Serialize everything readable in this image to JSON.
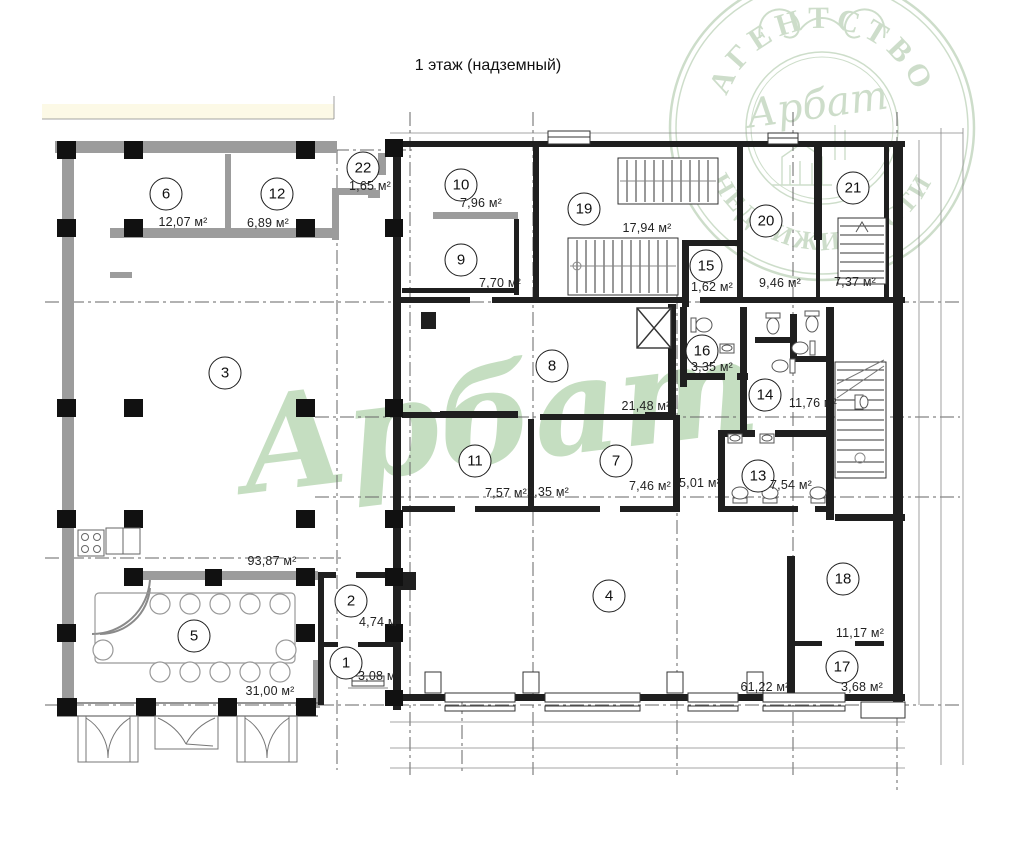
{
  "title": "1 этаж (надземный)",
  "units_suffix": "м²",
  "watermark": {
    "stamp_top_text": "АГЕНТСТВО",
    "stamp_bottom_text": "НЕДВИЖИМОСТИ",
    "stamp_script": "Арбат",
    "center_script": "Арбат",
    "color": "#97c48f"
  },
  "rooms": [
    {
      "number": "1",
      "area": "3,08 м²"
    },
    {
      "number": "2",
      "area": "4,74 м²"
    },
    {
      "number": "3",
      "area": "93,87 м²"
    },
    {
      "number": "4",
      "area": "61,22 м²"
    },
    {
      "number": "5",
      "area": "31,00 м²"
    },
    {
      "number": "6",
      "area": "12,07 м²"
    },
    {
      "number": "7",
      "area": "7,46 м²"
    },
    {
      "number": "8",
      "area": "21,48 м²"
    },
    {
      "number": "9",
      "area": "7,70 м²"
    },
    {
      "number": "10",
      "area": "7,96 м²"
    },
    {
      "number": "11",
      "area": "7,57 м²"
    },
    {
      "number": "12",
      "area": "6,89 м²"
    },
    {
      "number": "13",
      "area": "7,54 м²"
    },
    {
      "number": "14",
      "area": "11,76 м²"
    },
    {
      "number": "15",
      "area": "1,62 м²"
    },
    {
      "number": "16",
      "area": "3,35 м²"
    },
    {
      "number": "17",
      "area": "3,68 м²"
    },
    {
      "number": "18",
      "area": "11,17 м²"
    },
    {
      "number": "19",
      "area": "17,94 м²"
    },
    {
      "number": "20",
      "area": "9,46 м²"
    },
    {
      "number": "21",
      "area": "7,37 м²"
    },
    {
      "number": "22",
      "area": "1,65 м²"
    }
  ],
  "extra_areas": [
    {
      "area": "2,35 м²"
    },
    {
      "area": "5,01 м²"
    }
  ]
}
